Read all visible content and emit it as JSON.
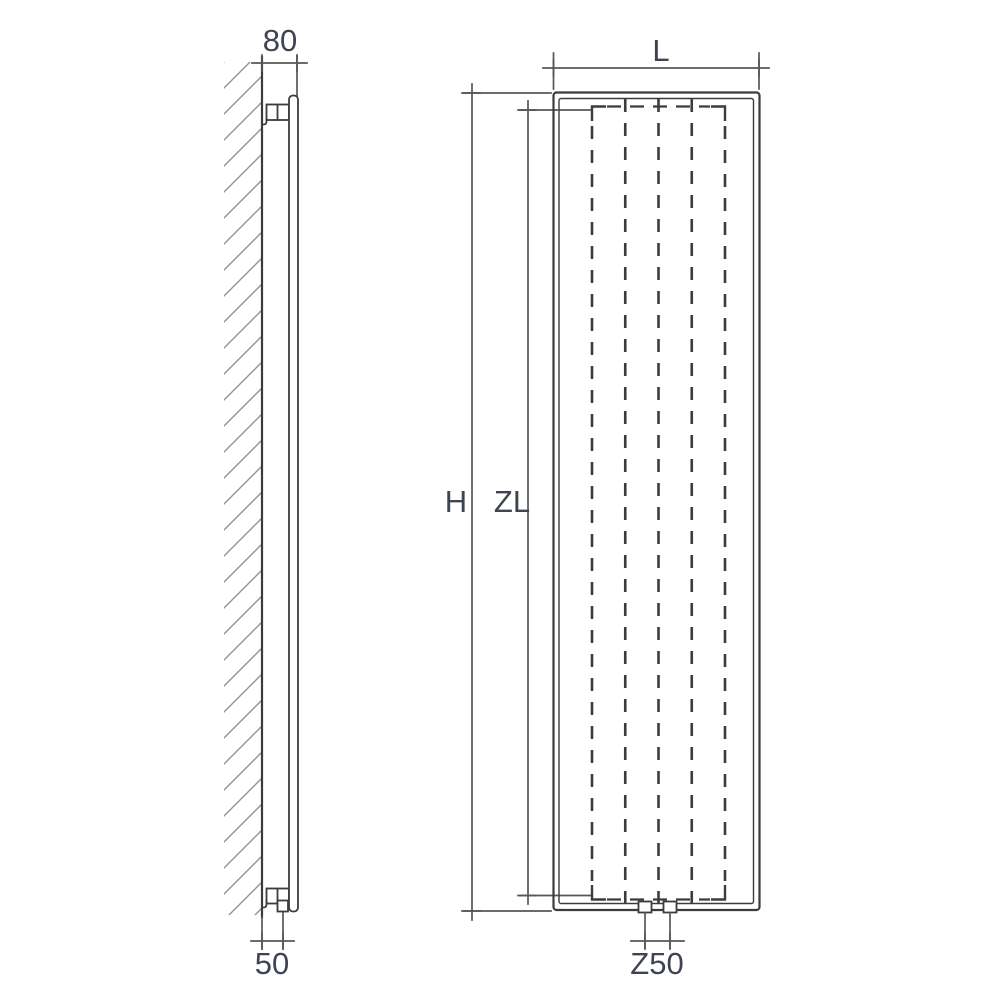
{
  "diagram": {
    "type": "radiator-dimension-drawing",
    "views": {
      "side": {
        "title": "side profile with wall mounting",
        "dimensions": {
          "top_depth": "80",
          "bottom_depth": "50"
        }
      },
      "front": {
        "title": "front elevation",
        "dimensions": {
          "width": "L",
          "height": "H",
          "element_height": "ZL",
          "connection_spacing": "Z50"
        }
      }
    },
    "colors": {
      "line": "#3c3c3c",
      "dim": "#575757",
      "hatch": "#8f9499",
      "text": "#3f4453",
      "bg": "#ffffff"
    }
  }
}
